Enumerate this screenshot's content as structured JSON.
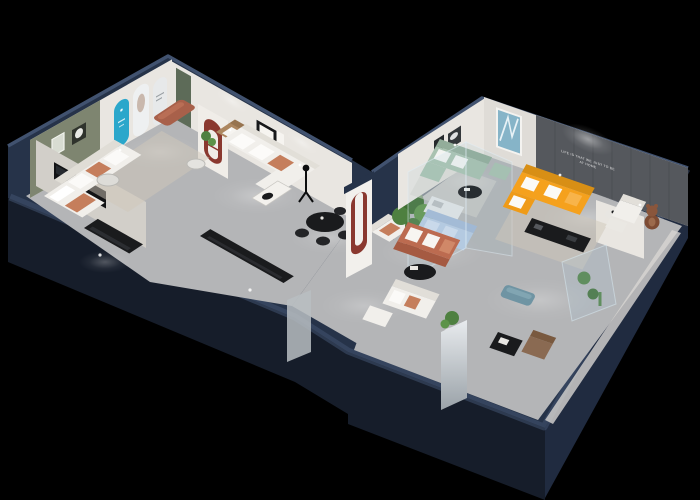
{
  "scene": {
    "type": "3d-isometric-floorplan-render",
    "setting": "cutaway furniture showroom apartment on black backdrop",
    "background": "#000000",
    "wall_slogan": {
      "line1": "LIFE IS THAT WE JUST TO BE",
      "line2": "AT HOME"
    },
    "areas": [
      {
        "name": "left-wing-lounge",
        "items": [
          "olive-accent-wall",
          "framed-art-pair",
          "blue-arch-poster",
          "white-arch-posters",
          "green-door",
          "white-sofa",
          "tan-sofa",
          "terracotta-ottoman",
          "round-glass-table",
          "potted-plant",
          "gray-rug"
        ]
      },
      {
        "name": "left-wing-bedroom",
        "items": [
          "bed-white-terracotta",
          "tv-panel",
          "black-console",
          "floor-lamp"
        ]
      },
      {
        "name": "center-living-room",
        "items": [
          "white-l-sofa",
          "coffee-table",
          "black-dining-table",
          "black-chairs",
          "red-arch-niche",
          "statue-floor-lamp",
          "white-armchair",
          "black-sideboard"
        ]
      },
      {
        "name": "junction-hall",
        "items": [
          "red-u-arch-partition",
          "potted-tree",
          "bright-doorway"
        ]
      },
      {
        "name": "right-wing-lounge",
        "items": [
          "sage-l-sofa",
          "black-oval-table",
          "blue-abstract-art",
          "dark-framed-art",
          "light-rug"
        ]
      },
      {
        "name": "right-wing-living-room",
        "items": [
          "orange-l-sofa",
          "dark-slogan-wall",
          "black-media-console",
          "white-armchair",
          "teddy-bear-figure",
          "round-side-table",
          "beige-rug"
        ]
      },
      {
        "name": "glass-display-cube",
        "items": [
          "light-blue-sofa",
          "white-cabinet"
        ]
      },
      {
        "name": "lower-gallery",
        "items": [
          "terracotta-sofa",
          "black-oval-coffee-table",
          "white-sofa-set",
          "plant-stand",
          "teal-bench",
          "brown-armchair",
          "black-magazine-table",
          "glass-vitrine-plants",
          "glass-door",
          "white-partition"
        ]
      }
    ]
  },
  "palette": {
    "background": "#000000",
    "outer_wall": "#263349",
    "outer_wall_mid": "#202b40",
    "outer_wall_dark": "#161d2a",
    "outer_wall_cap": "#41526f",
    "floor": "#b4b5b7",
    "floor_light": "#cbccce",
    "wall_white": "#e9e6e1",
    "wall_shadow": "#d2cfc9",
    "accent_olive": "#7e8570",
    "accent_slogan_wall": "#55585d",
    "arch_blue": "#2ba7cb",
    "arch_red": "#8a382f",
    "door_green": "#5d6b58",
    "sofa_white": "#f1efeb",
    "sofa_tan": "#ad8760",
    "sofa_terracotta": "#bc6b50",
    "sofa_orange": "#f5a11d",
    "sofa_sage": "#a9c2b0",
    "sofa_blue": "#b7cbe3",
    "cushion_terracotta": "#c57e5c",
    "table_black": "#1a1b1d",
    "rug": "#cfc8ba",
    "plant": "#4e8040",
    "glass": "#a9c8da",
    "teddy_brown": "#7d4b33",
    "bench_teal": "#6f94a3",
    "chair_brown": "#8a6a52"
  }
}
